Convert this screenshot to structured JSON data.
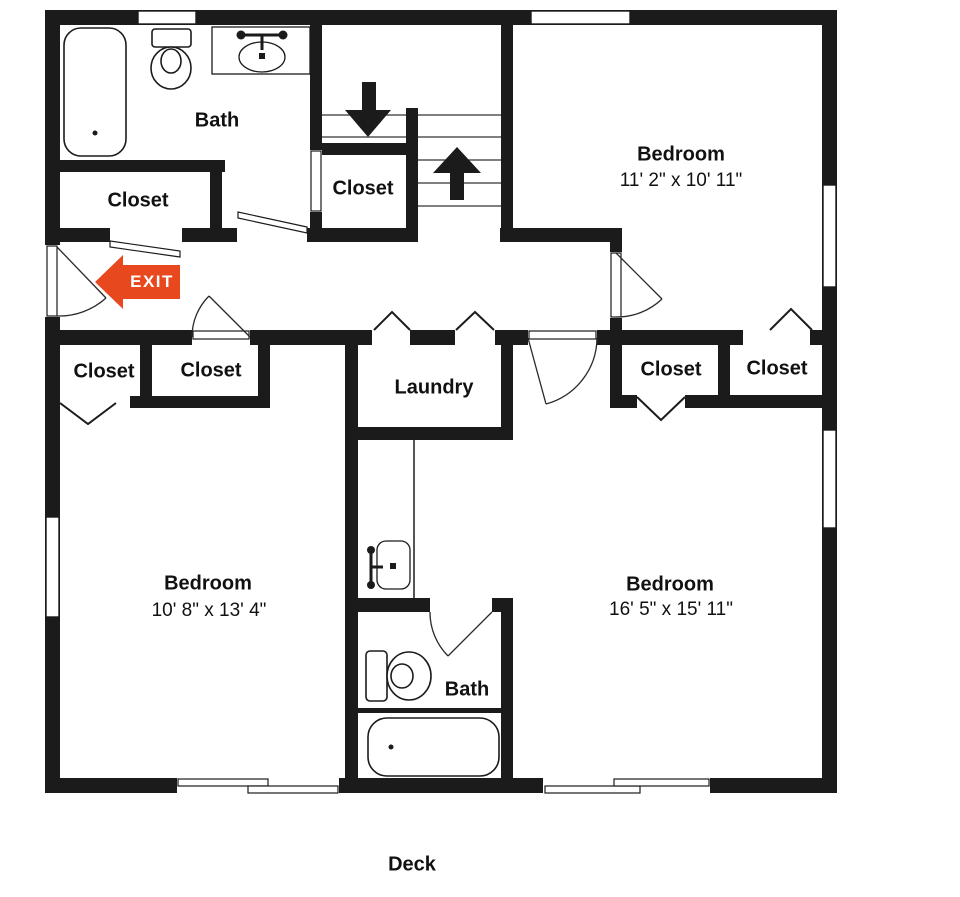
{
  "colors": {
    "wall": "#1b1b1b",
    "background": "#ffffff",
    "exit_arrow": "#e8481e",
    "exit_text": "#ffffff"
  },
  "rooms": {
    "bath_upper": {
      "label": "Bath"
    },
    "closet_bath": {
      "label": "Closet"
    },
    "closet_stair": {
      "label": "Closet"
    },
    "bedroom_top_right": {
      "label": "Bedroom",
      "dimensions": "11' 2\" x 10' 11\""
    },
    "closet_hall_left": {
      "label": "Closet"
    },
    "closet_hall_right": {
      "label": "Closet"
    },
    "laundry": {
      "label": "Laundry"
    },
    "closet_bedroom_right_a": {
      "label": "Closet"
    },
    "closet_bedroom_right_b": {
      "label": "Closet"
    },
    "bedroom_bottom_left": {
      "label": "Bedroom",
      "dimensions": "10' 8\" x 13' 4\""
    },
    "bedroom_bottom_right": {
      "label": "Bedroom",
      "dimensions": "16' 5\" x 15' 11\""
    },
    "bath_lower": {
      "label": "Bath"
    },
    "deck": {
      "label": "Deck"
    }
  },
  "annotations": {
    "exit": {
      "label": "EXIT",
      "direction": "left"
    }
  }
}
